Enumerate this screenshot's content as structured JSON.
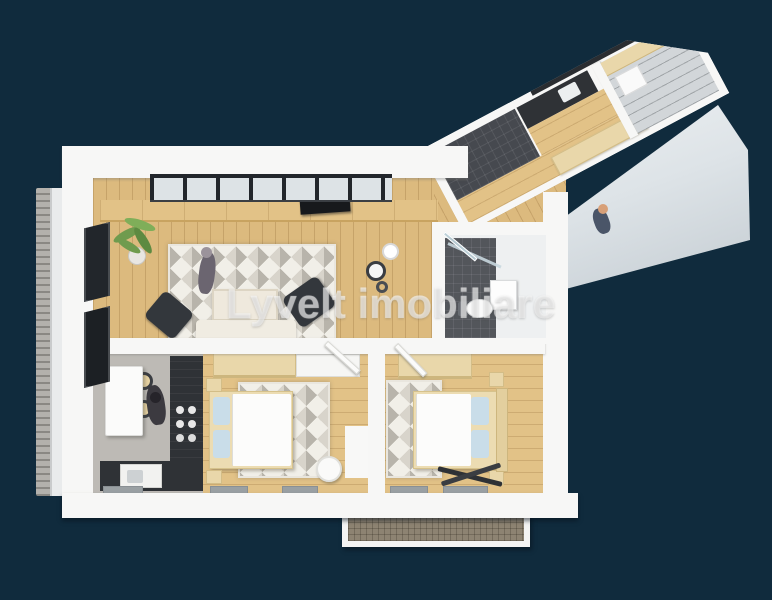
{
  "watermark": {
    "text": "Lyvelt imobiliare"
  },
  "palette": {
    "bg_navy": "#102b3d",
    "wall_white": "#f7f7f6",
    "wall_shadow": "#dfe2e4",
    "wood_floor": "#dcba7e",
    "wood_light": "#e2c287",
    "rug_base": "#f1efe8",
    "rug_gray1": "#d8d4cb",
    "rug_gray2": "#b8b4ab",
    "dark_furniture": "#33373c",
    "counter_dark": "#2f3236",
    "cabinet_beige": "#e9d7aa",
    "tile_dark": "#46494f",
    "floor_gray": "#bdbab5",
    "glass_dark": "#22262b",
    "pillow_blue": "#c9dde9",
    "balcony_floor": "#8d8372",
    "slab_light": "#dde3e7",
    "plant_green": "#6f9b4e",
    "toilet_white": "#fbfbfb"
  },
  "scene": {
    "type": "3d-floor-plan-render",
    "rooms": [
      "living-room",
      "dining-kitchen",
      "bedroom-1",
      "bedroom-2",
      "bathroom",
      "kitchen-wing",
      "balcony-left",
      "balcony-bottom"
    ]
  }
}
